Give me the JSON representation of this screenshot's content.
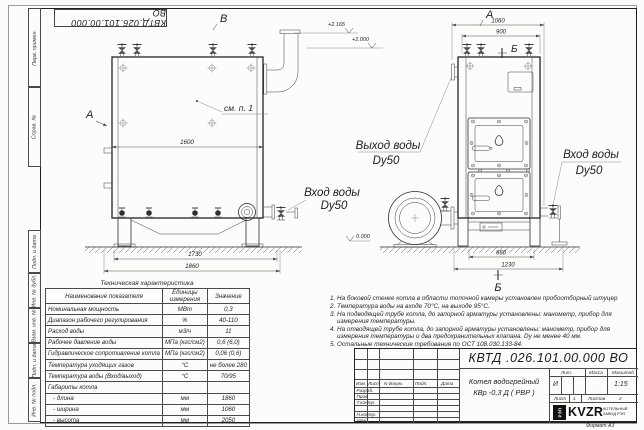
{
  "doc": {
    "number_flipped": "КВТД.026.101.00.000  ВО"
  },
  "margin": {
    "labels": [
      "Перв. примен.",
      "Справ. №",
      "Подп. и дата",
      "Инв. № дубл.",
      "Взам. инв. №",
      "Подп. и дата",
      "Инв. № подл."
    ]
  },
  "drawing": {
    "label_v": "В",
    "label_a_side": "А",
    "label_a_front": "А",
    "label_b_top": "Б",
    "label_b_bottom": "Б",
    "callout_see_p1": "см. п. 1",
    "dim_1600": "1600",
    "dim_1730": "1730",
    "dim_1860": "1860",
    "dim_1060": "1060",
    "dim_900": "900",
    "dim_660": "660",
    "dim_1230": "1230",
    "lvl_2165": "+2.165",
    "lvl_2000": "+2.000",
    "lvl_0": "0.000",
    "outlet_label": "Выход воды",
    "outlet_dn": "Dy50",
    "inlet_side_label": "Вход воды",
    "inlet_side_dn": "Dy50",
    "inlet_front_label": "Вход воды",
    "inlet_front_dn": "Dy50"
  },
  "spec_table": {
    "title": "Техническая характеристика",
    "headers": [
      "Наименование показателя",
      "Единицы измерения",
      "Значение"
    ],
    "rows": [
      [
        "Номинальная мощность",
        "МВт",
        "0,3"
      ],
      [
        "Диапазон рабочего регулирования",
        "%",
        "40-110"
      ],
      [
        "Расход воды",
        "м3/ч",
        "11"
      ],
      [
        "Рабочее давление воды",
        "МПа (кгс/см2)",
        "0,6 (6,0)"
      ],
      [
        "Гидравлическое сопротивление котла",
        "МПа (кгс/см2)",
        "0,06 (0,6)"
      ],
      [
        "Температура уходящих газов",
        "°С",
        "не более 280"
      ],
      [
        "Температура воды (Вход/выход)",
        "°С",
        "70/95"
      ],
      [
        "Габариты котла",
        "",
        ""
      ],
      [
        "   - длина",
        "мм",
        "1860"
      ],
      [
        "   - ширина",
        "мм",
        "1060"
      ],
      [
        "   - высота",
        "мм",
        "2050"
      ]
    ]
  },
  "notes": [
    "1.  На боковой стенке котла в области топочной камеры установлен пробоотборный штуцер",
    "2.  Температура воды на входе 70°С, на выходе 95°С.",
    "3.  На подводящей трубе котла, до запорной арматуры установлены: манометр, прибор для измерения температуры.",
    "4.  На отводящей трубе котла, до запорной арматуры установлены: манометр, прибор для измерения температуры и два предохранительных клапана. Dу не менее 40 мм.",
    "5.  Остальные технические требования по ОСТ 108.030.133-84."
  ],
  "title_block": {
    "doc_number": "КВТД .026.101.00.000  ВО",
    "header_cells": [
      "Изм.",
      "Лист",
      "N докум.",
      "Подп.",
      "Дата"
    ],
    "roles": [
      "Разраб.",
      "Пров.",
      "Т.контр.",
      "Н.контр.",
      "Утв."
    ],
    "product_line1": "Котел водогрейный",
    "product_line2": "КВр -0,3  Д  ( РВР )",
    "lit_label": "Лит.",
    "mass_label": "Масса",
    "scale_label": "Масштаб",
    "lit_value": "И",
    "scale_value": "1:15",
    "sheet_label": "Лист",
    "sheet_value": "1",
    "sheets_label": "Листов",
    "sheets_value": "2",
    "logo_mark": "РЭП",
    "logo_name": "KVZR",
    "company_line1": "КОТЕЛЬНЫЙ",
    "company_line2": "ЗАВОД РЭП",
    "format": "Формат  А3"
  }
}
